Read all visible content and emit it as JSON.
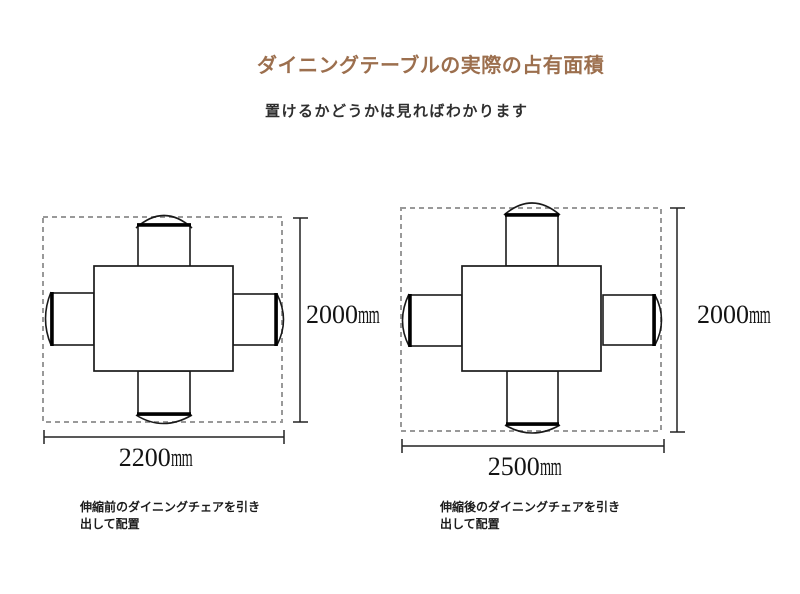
{
  "page": {
    "background": "#ffffff"
  },
  "header": {
    "title": "ダイニングテーブルの実際の占有面積",
    "title_color": "#9c6f4e",
    "subtitle": "置けるかどうかは見ればわかります",
    "subtitle_color": "#2f2f2f"
  },
  "colors": {
    "solid_line": "#1a1a1a",
    "dashed_outline": "#999999",
    "dimension_text": "#141414",
    "caption_text": "#1c1c1c"
  },
  "diagrams": [
    {
      "width_label": {
        "value": "2200",
        "unit": "mm"
      },
      "height_label": {
        "value": "2000",
        "unit": "mm"
      },
      "caption_line1": "伸縮前のダイニングチェアを引き",
      "caption_line2": "出して配置"
    },
    {
      "width_label": {
        "value": "2500",
        "unit": "mm"
      },
      "height_label": {
        "value": "2000",
        "unit": "mm"
      },
      "caption_line1": "伸縮後のダイニングチェアを引き",
      "caption_line2": "出して配置"
    }
  ]
}
